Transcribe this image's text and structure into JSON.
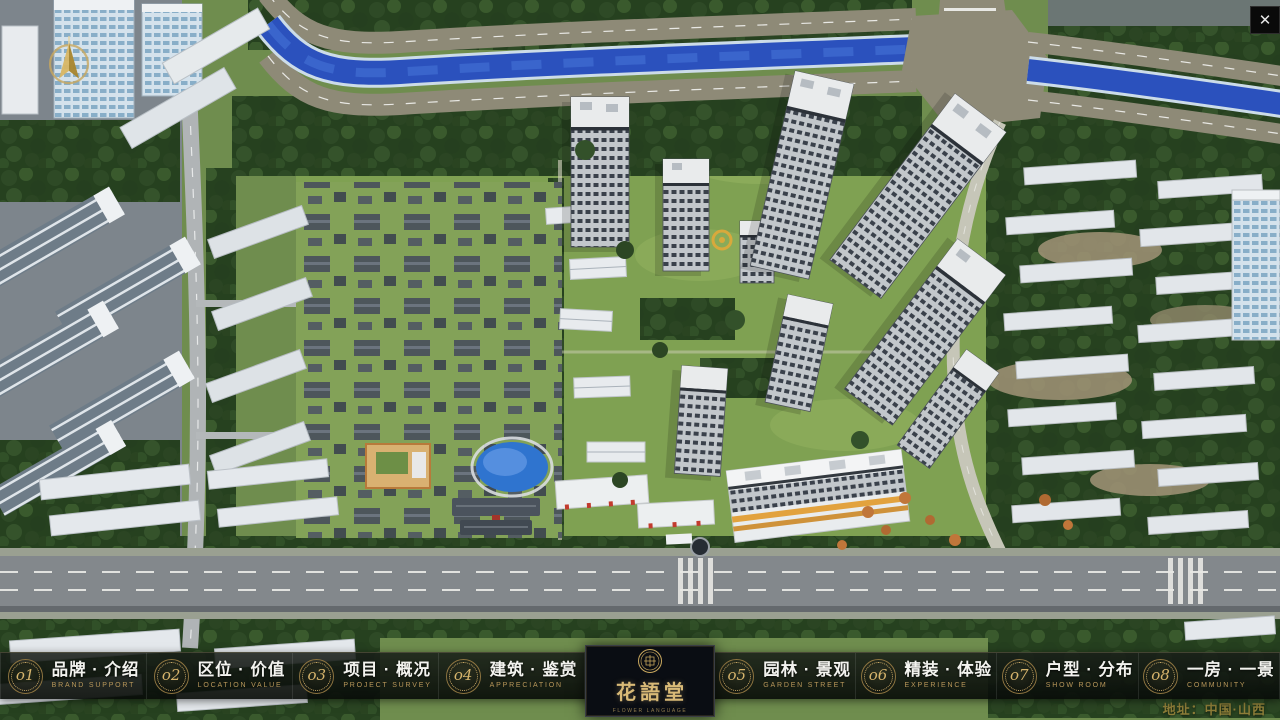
{
  "icons": {
    "close": "✕"
  },
  "nav": {
    "items": [
      {
        "num": "o1",
        "label": "品牌 · 介绍",
        "sub": "BRAND SUPPORT"
      },
      {
        "num": "o2",
        "label": "区位 · 价值",
        "sub": "LOCATION VALUE"
      },
      {
        "num": "o3",
        "label": "项目 · 概况",
        "sub": "PROJECT SURVEY"
      },
      {
        "num": "o4",
        "label": "建筑 · 鉴赏",
        "sub": "APPRECIATION"
      },
      {
        "num": "o5",
        "label": "园林 · 景观",
        "sub": "GARDEN STREET"
      },
      {
        "num": "o6",
        "label": "精装 · 体验",
        "sub": "EXPERIENCE"
      },
      {
        "num": "o7",
        "label": "户型 · 分布",
        "sub": "SHOW ROOM"
      },
      {
        "num": "o8",
        "label": "一房 · 一景",
        "sub": "COMMUNITY"
      }
    ]
  },
  "logo": {
    "title": "花語堂",
    "subtitle": "FLOWER LANGUAGE"
  },
  "footer": {
    "address": "地址：中国·山西"
  },
  "colors": {
    "gold": "#c9a85e",
    "bar_bg": "rgba(13,17,13,0.85)",
    "panel_bg": "#0a0d13",
    "river": "#2b51bd"
  }
}
